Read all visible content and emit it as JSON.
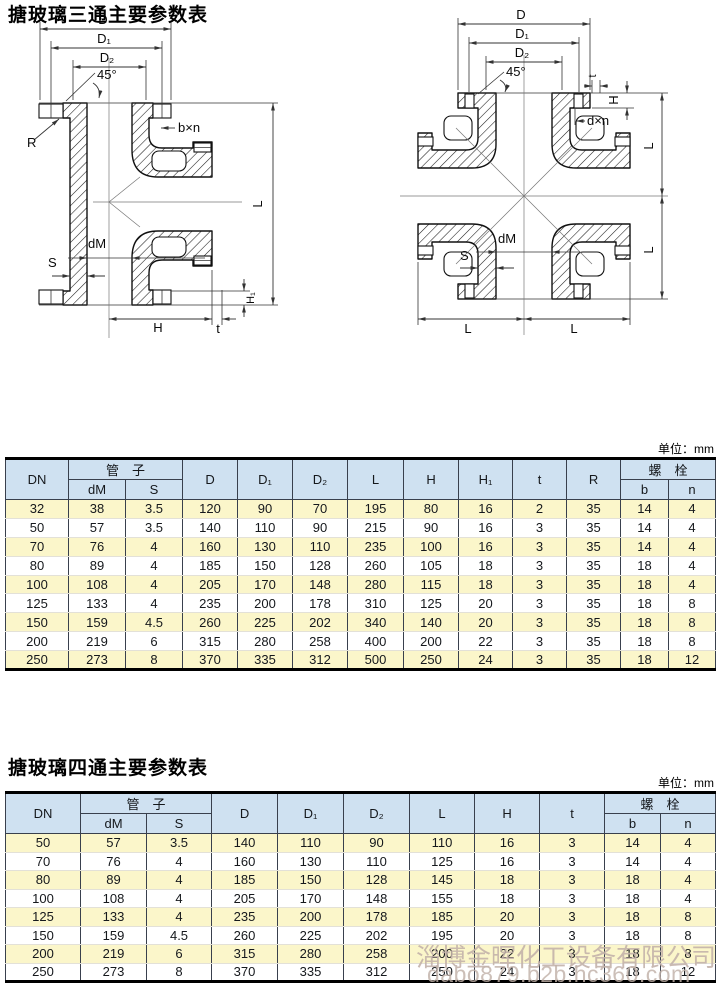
{
  "diagrams": {
    "tee": {
      "labels": {
        "d": "D",
        "d1": "D₁",
        "d2": "D₂",
        "angle": "45°",
        "bxn": "b×n",
        "r": "R",
        "l": "L",
        "dm": "dM",
        "s": "S",
        "h1": "H₁",
        "h": "H",
        "t": "t"
      }
    },
    "cross": {
      "labels": {
        "d": "D",
        "d1": "D₁",
        "d2": "D₂",
        "angle": "45°",
        "t": "t",
        "h": "H",
        "dxn": "d×n",
        "l_right_top": "L",
        "l_right_bottom": "L",
        "dm": "dM",
        "s": "S",
        "l_bottom_left": "L",
        "l_bottom_right": "L"
      }
    }
  },
  "table1": {
    "title": "搪玻璃三通主要参数表",
    "unit": "单位：mm",
    "headers": {
      "dn": "DN",
      "pipe": "管　子",
      "dm": "dM",
      "s": "S",
      "d": "D",
      "d1": "D₁",
      "d2": "D₂",
      "l": "L",
      "h": "H",
      "h1": "H₁",
      "t": "t",
      "r": "R",
      "bolt": "螺　栓",
      "b": "b",
      "n": "n"
    },
    "rows": [
      [
        "32",
        "38",
        "3.5",
        "120",
        "90",
        "70",
        "195",
        "80",
        "16",
        "2",
        "35",
        "14",
        "4"
      ],
      [
        "50",
        "57",
        "3.5",
        "140",
        "110",
        "90",
        "215",
        "90",
        "16",
        "3",
        "35",
        "14",
        "4"
      ],
      [
        "70",
        "76",
        "4",
        "160",
        "130",
        "110",
        "235",
        "100",
        "16",
        "3",
        "35",
        "14",
        "4"
      ],
      [
        "80",
        "89",
        "4",
        "185",
        "150",
        "128",
        "260",
        "105",
        "18",
        "3",
        "35",
        "18",
        "4"
      ],
      [
        "100",
        "108",
        "4",
        "205",
        "170",
        "148",
        "280",
        "115",
        "18",
        "3",
        "35",
        "18",
        "4"
      ],
      [
        "125",
        "133",
        "4",
        "235",
        "200",
        "178",
        "310",
        "125",
        "20",
        "3",
        "35",
        "18",
        "8"
      ],
      [
        "150",
        "159",
        "4.5",
        "260",
        "225",
        "202",
        "340",
        "140",
        "20",
        "3",
        "35",
        "18",
        "8"
      ],
      [
        "200",
        "219",
        "6",
        "315",
        "280",
        "258",
        "400",
        "200",
        "22",
        "3",
        "35",
        "18",
        "8"
      ],
      [
        "250",
        "273",
        "8",
        "370",
        "335",
        "312",
        "500",
        "250",
        "24",
        "3",
        "35",
        "18",
        "12"
      ]
    ]
  },
  "table2": {
    "title": "搪玻璃四通主要参数表",
    "unit": "单位：mm",
    "headers": {
      "dn": "DN",
      "pipe": "管　子",
      "dm": "dM",
      "s": "S",
      "d": "D",
      "d1": "D₁",
      "d2": "D₂",
      "l": "L",
      "h": "H",
      "t": "t",
      "bolt": "螺　栓",
      "b": "b",
      "n": "n"
    },
    "rows": [
      [
        "50",
        "57",
        "3.5",
        "140",
        "110",
        "90",
        "110",
        "16",
        "3",
        "14",
        "4"
      ],
      [
        "70",
        "76",
        "4",
        "160",
        "130",
        "110",
        "125",
        "16",
        "3",
        "14",
        "4"
      ],
      [
        "80",
        "89",
        "4",
        "185",
        "150",
        "128",
        "145",
        "18",
        "3",
        "18",
        "4"
      ],
      [
        "100",
        "108",
        "4",
        "205",
        "170",
        "148",
        "155",
        "18",
        "3",
        "18",
        "4"
      ],
      [
        "125",
        "133",
        "4",
        "235",
        "200",
        "178",
        "185",
        "20",
        "3",
        "18",
        "8"
      ],
      [
        "150",
        "159",
        "4.5",
        "260",
        "225",
        "202",
        "195",
        "20",
        "3",
        "18",
        "8"
      ],
      [
        "200",
        "219",
        "6",
        "315",
        "280",
        "258",
        "200",
        "22",
        "3",
        "18",
        "8"
      ],
      [
        "250",
        "273",
        "8",
        "370",
        "335",
        "312",
        "250",
        "24",
        "3",
        "18",
        "12"
      ]
    ]
  },
  "watermark": {
    "company": "淄博金晖化工设备有限公司",
    "site": "dabo879.b2b.hc360.com"
  }
}
